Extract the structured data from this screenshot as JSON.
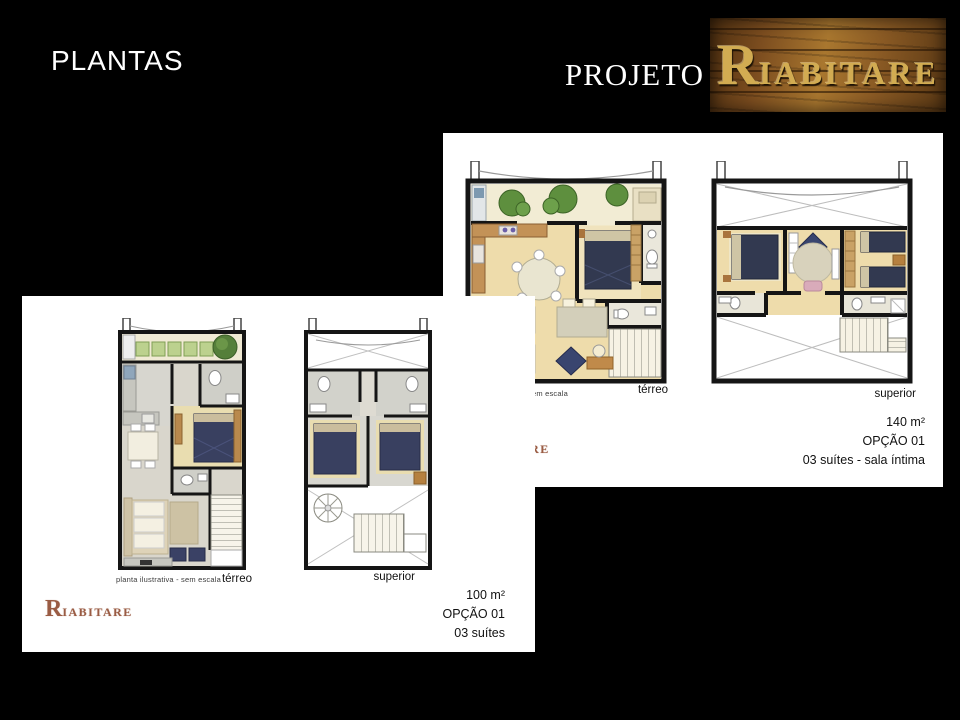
{
  "slide": {
    "title": "PLANTAS",
    "project_label": "PROJETO"
  },
  "logo": {
    "initial": "R",
    "rest": "IABITARE"
  },
  "cards": [
    {
      "id": "opcao-140",
      "area": "140 m²",
      "option": "OPÇÃO 01",
      "description": "03 suítes - sala íntima",
      "floor_note": "planta ilustrativa - sem escala",
      "ground_label": "térreo",
      "upper_label": "superior",
      "brand_initial": "R",
      "brand_rest": "IABITARE"
    },
    {
      "id": "opcao-100",
      "area": "100 m²",
      "option": "OPÇÃO 01",
      "description": "03 suítes",
      "floor_note": "planta ilustrativa - sem escala",
      "ground_label": "térreo",
      "upper_label": "superior",
      "brand_initial": "R",
      "brand_rest": "IABITARE"
    }
  ],
  "colors": {
    "background": "#000000",
    "card": "#ffffff",
    "wall": "#151515",
    "wood_floor": "#eedcab",
    "gray_floor": "#d7d6cf",
    "terrace": "#f2ecd4",
    "tree": "#5e8f3e",
    "bed": "#323950",
    "rug_blue": "#39456f",
    "counter_brown": "#c39257",
    "brand_brown": "#9a5c44",
    "logo_gold": "#d2ac52"
  }
}
